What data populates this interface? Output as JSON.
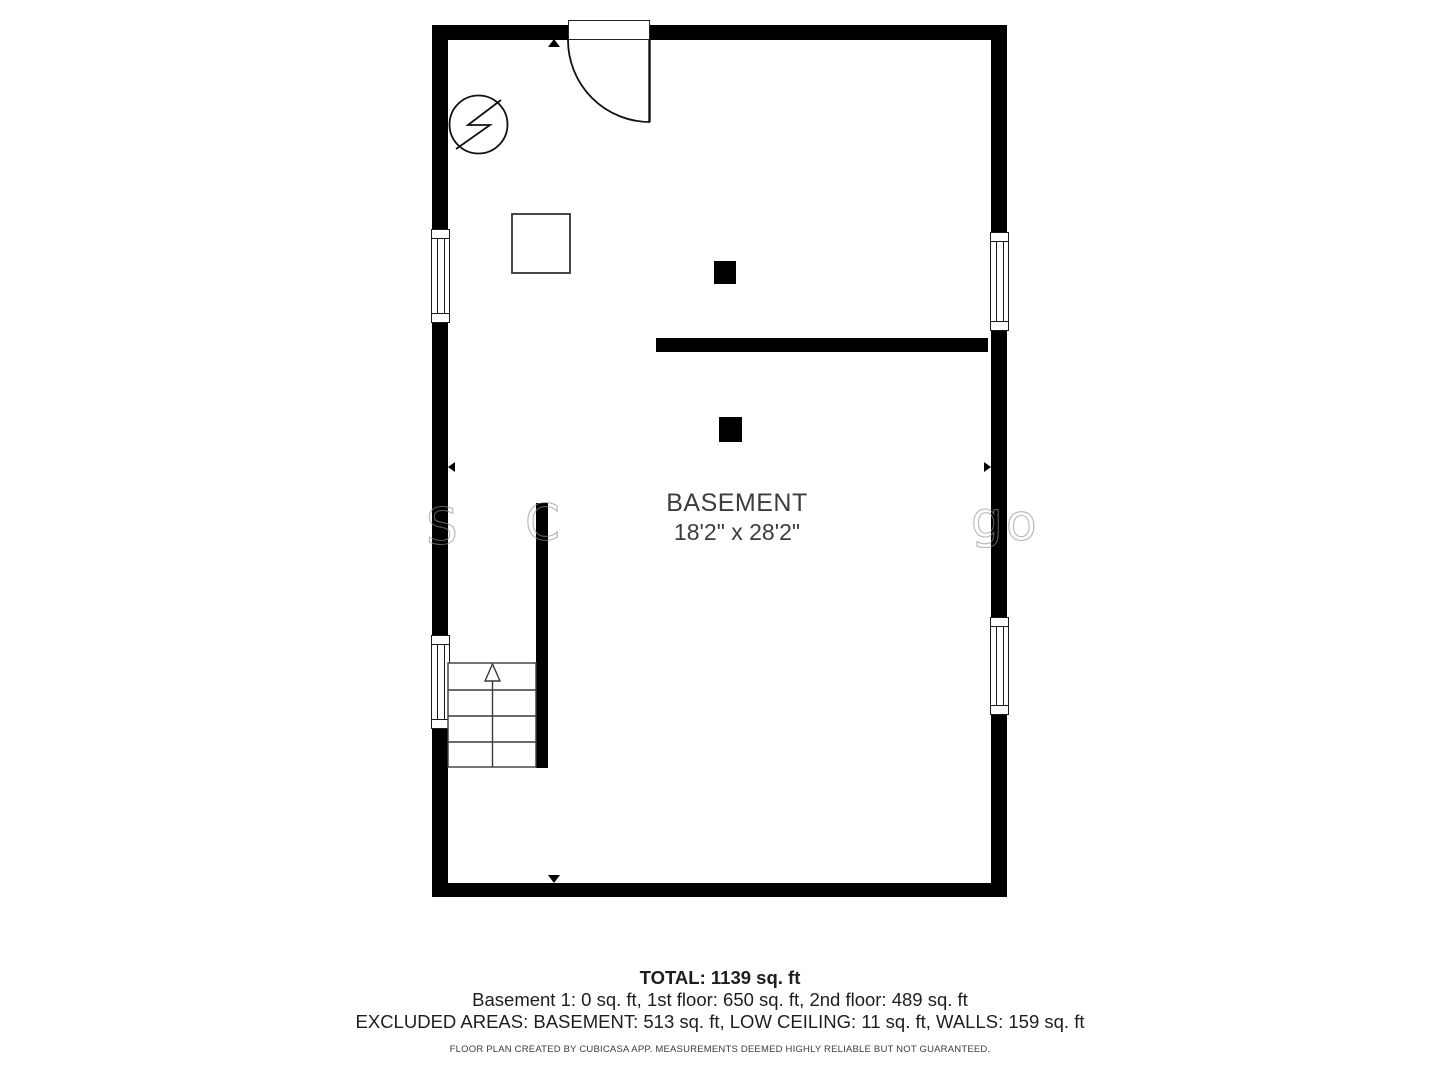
{
  "floorplan": {
    "room": {
      "name": "BASEMENT",
      "dimensions": "18'2\" x 28'2\""
    },
    "summary": {
      "total": "TOTAL: 1139 sq. ft",
      "floors": "Basement 1: 0 sq. ft, 1st floor: 650 sq. ft, 2nd floor: 489 sq. ft",
      "excluded": "EXCLUDED AREAS: BASEMENT: 513 sq. ft, LOW CEILING: 11 sq. ft, WALLS: 159 sq. ft",
      "disclaimer": "FLOOR PLAN CREATED BY CUBICASA APP. MEASUREMENTS DEEMED HIGHLY RELIABLE BUT NOT GUARANTEED."
    },
    "watermark": {
      "letters": [
        "S",
        "C",
        "g",
        "o"
      ]
    },
    "icons": [
      "electrical-panel-icon",
      "door-swing-icon",
      "window-icon",
      "stairs-up-icon",
      "column-post-icon",
      "direction-marker-icon"
    ],
    "colors": {
      "wall": "#000000",
      "line": "#2e2e2e",
      "room_label": "#3d3d3d",
      "summary_text": "#1e1e1e"
    }
  }
}
